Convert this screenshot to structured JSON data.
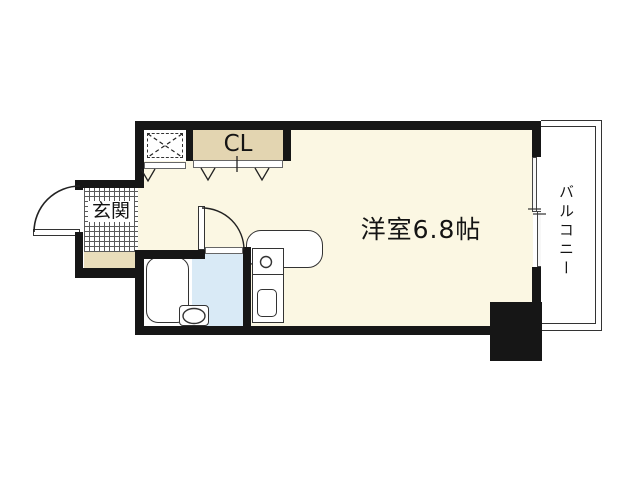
{
  "floorplan": {
    "labels": {
      "main_room": "洋室6.8帖",
      "closet": "CL",
      "entrance": "玄関",
      "balcony": "バルコニー"
    },
    "colors": {
      "wall": "#161616",
      "room_floor": "#FBF7E3",
      "closet_fill": "#E3D5B1",
      "entrance_step_fill": "#E9DDBB",
      "bath_floor_blue": "#D9EAF6",
      "fixture_outline": "#333333",
      "background": "#FFFFFF"
    }
  }
}
